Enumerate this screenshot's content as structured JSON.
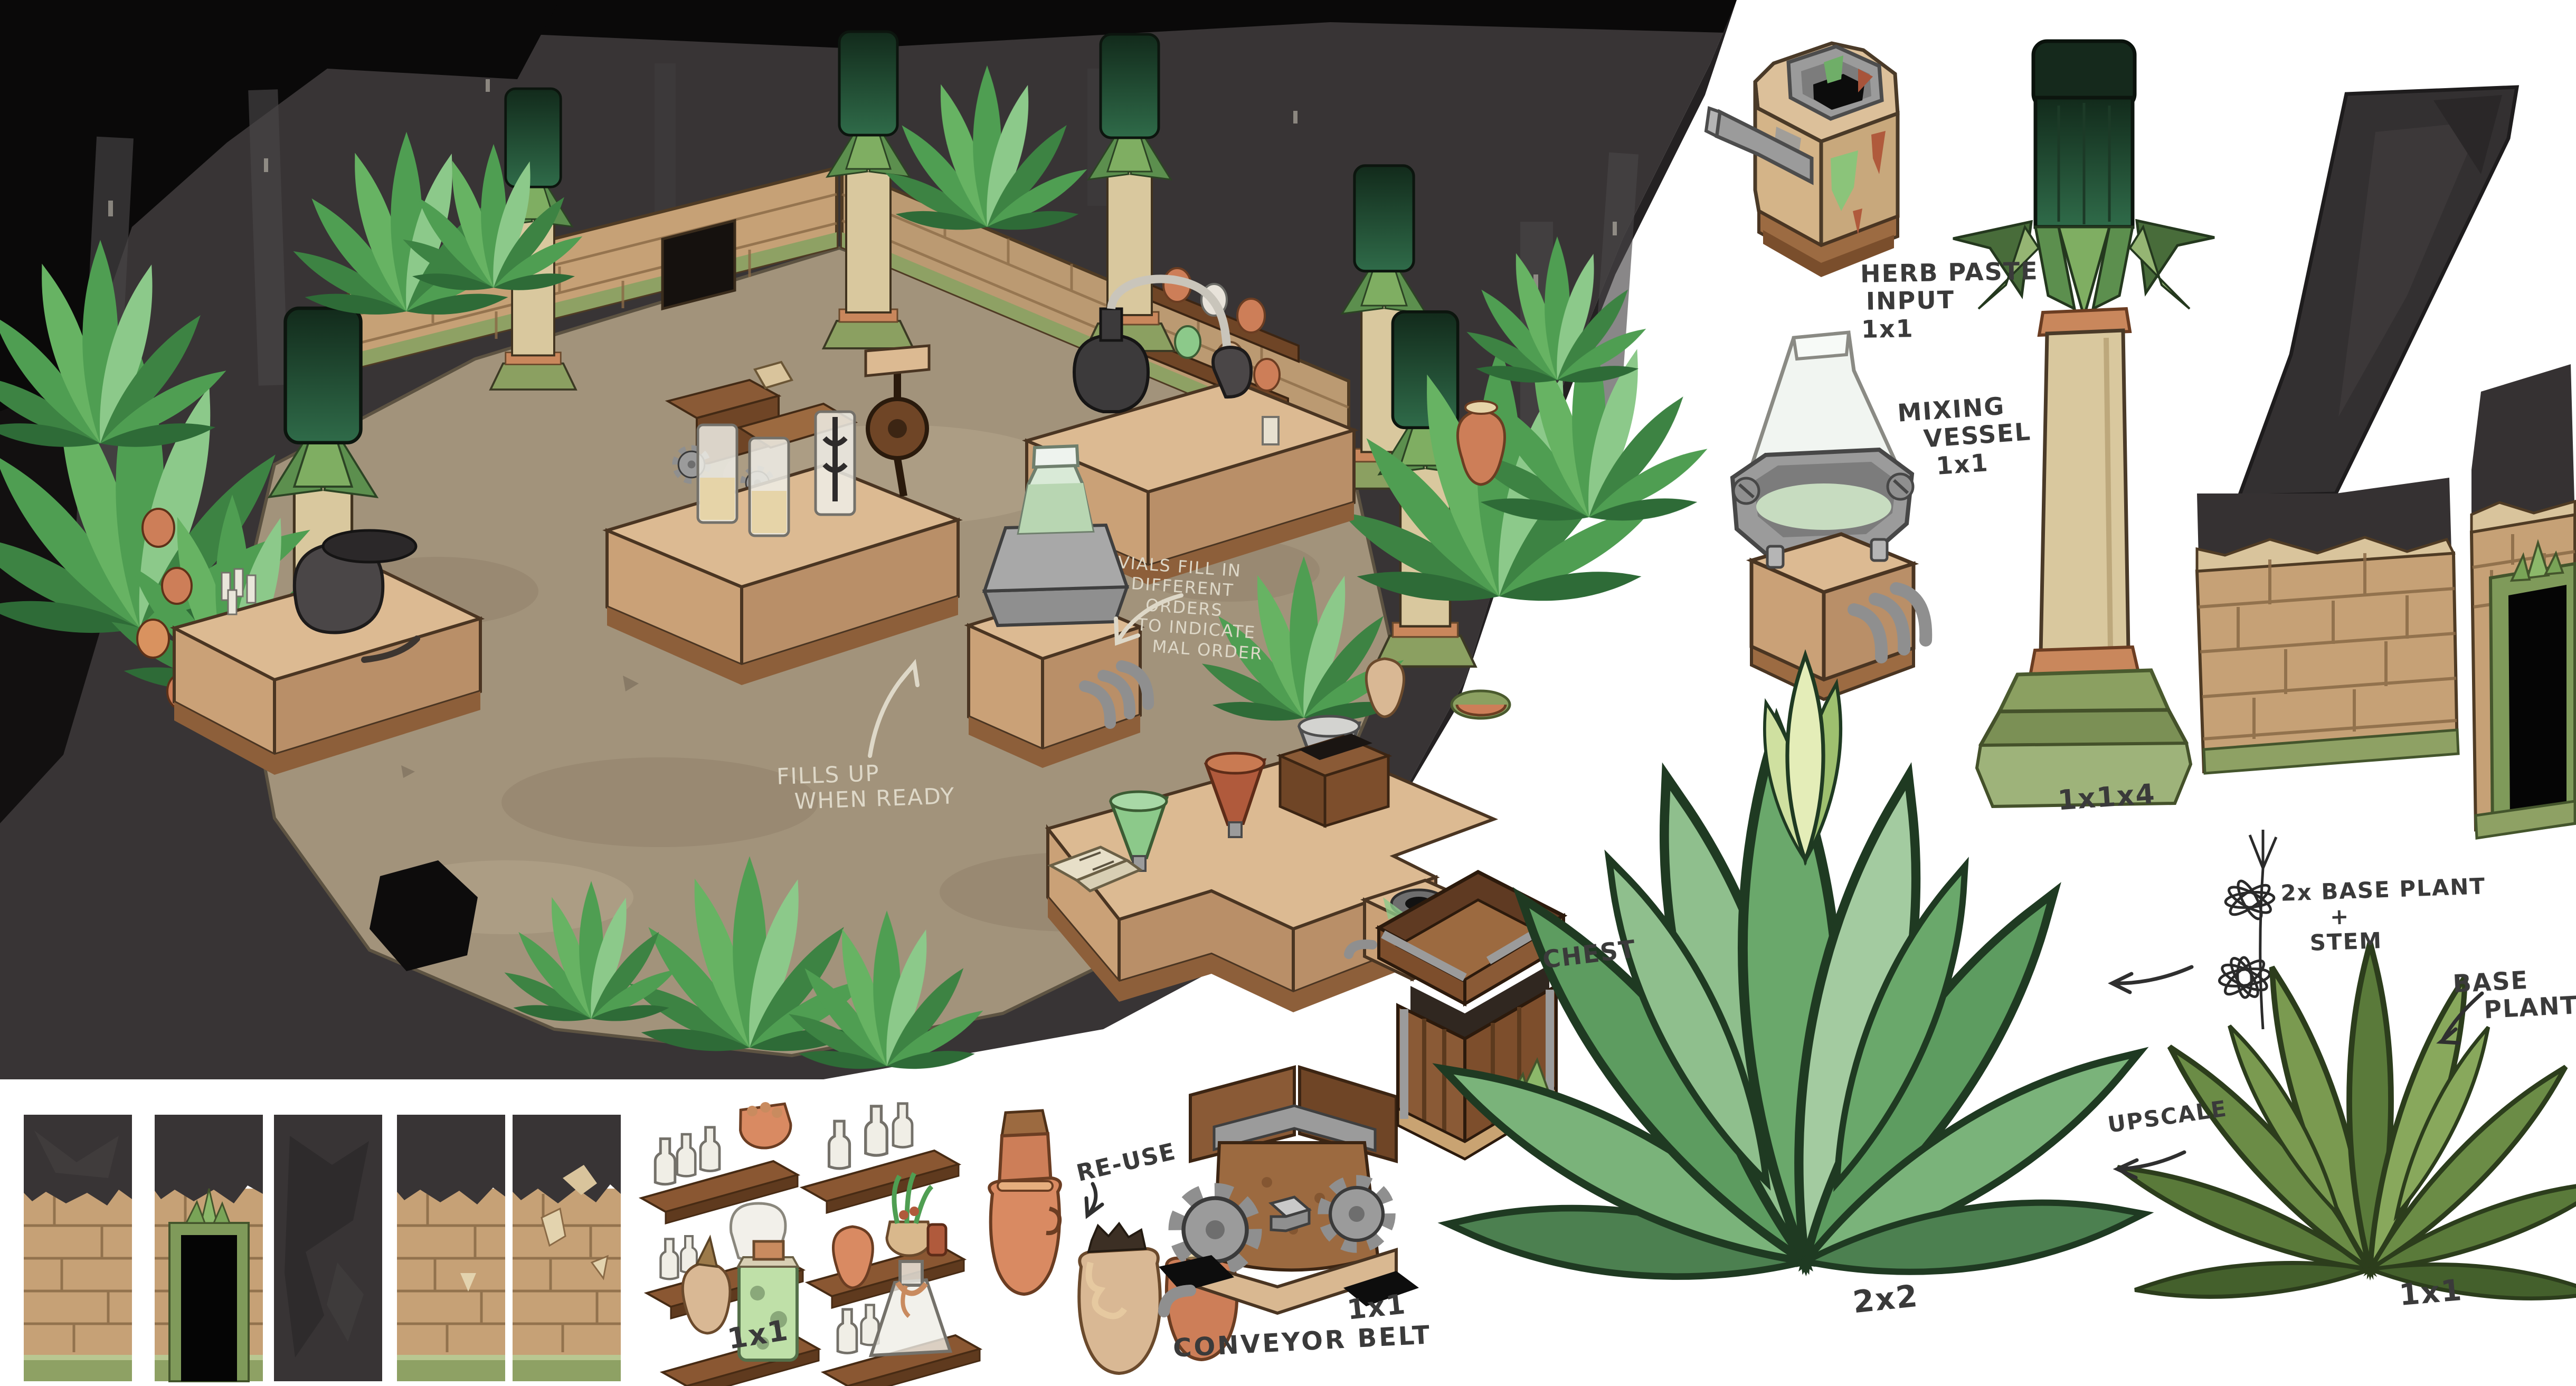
{
  "colors": {
    "canvas_bg": "#ffffff",
    "cave_black": "#0a0909",
    "cave_rock": "#383435",
    "floor_tan": "#a2937b",
    "brick_tan": "#c6a176",
    "trim_green": "#8ea164",
    "plant_green": "#4f9e52",
    "plant_olive": "#6b8c46",
    "column_shaft": "#d9c89e",
    "column_top_green": "#2f6b49",
    "table_wood": "#dcba92",
    "shelf_wood": "#8a5732",
    "terracotta": "#cd7e58",
    "metal_gray": "#9b9b9b",
    "ink": "#3a3a3a",
    "chalk": "#ded8c8"
  },
  "scene_notes": {
    "fills_note": [
      "FILLS UP",
      "WHEN READY"
    ],
    "vials_note": [
      "VIALS FILL IN",
      "DIFFERENT",
      "ORDERS",
      "TO INDICATE",
      "MAL ORDER"
    ]
  },
  "callouts": {
    "herb_paste": [
      "HERB PASTE",
      "INPUT",
      "1x1"
    ],
    "mixing_vessel": [
      "MIXING",
      "VESSEL",
      "1x1"
    ],
    "column_size": "1x1x4",
    "chest": "CHEST",
    "shelf_size": "1x1",
    "reuse": "RE-USE",
    "conveyor": "CONVEYOR BELT",
    "conveyor_size": "1x1",
    "plant_large_size": "2x2",
    "plant_sketch": [
      "2x BASE PLANT",
      "+",
      "STEM"
    ],
    "base_plant": [
      "BASE",
      "PLANT"
    ],
    "base_plant_size": "1x1",
    "upscale": "UPSCALE"
  }
}
